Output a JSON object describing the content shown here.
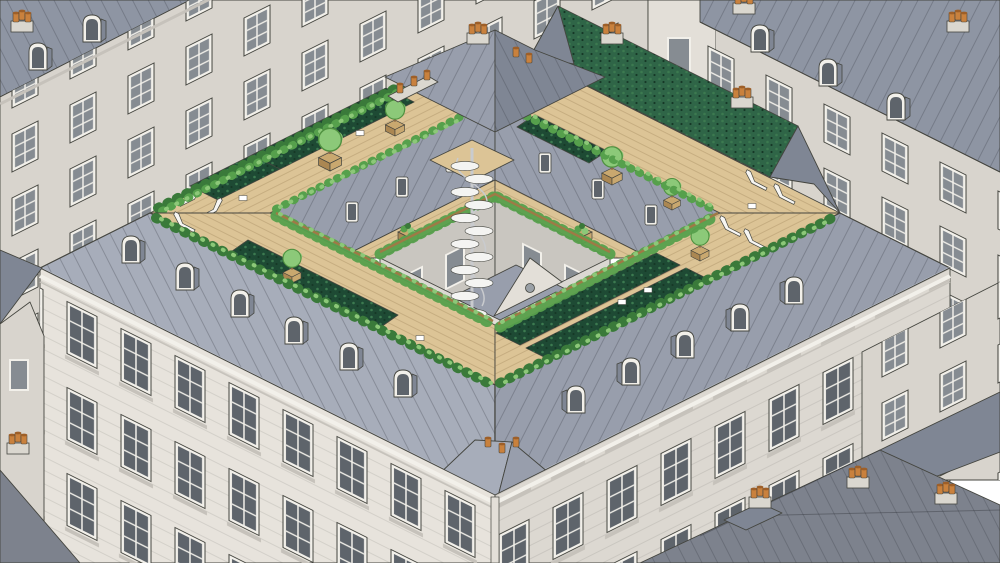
{
  "scene": {
    "description": "Isometric architectural illustration of a Parisian Haussmann-style courtyard block whose rooftops are converted into wooden garden terraces with planters, vegetable beds, sedum green roofs, trees, lounge chairs and a white spiral staircase connecting two terrace levels around the inner courtyard.",
    "objects": [
      "background-apartment-buildings",
      "mansard-roofs",
      "dormer-windows",
      "chimney-stacks-with-terracotta-pots",
      "rooftop-wood-deck-terraces",
      "raised-vegetable-beds",
      "planter-boxes-with-trees",
      "shrub-hedges",
      "climbing-plants-on-railings",
      "white-lounge-chairs",
      "sedum-green-roof-slope",
      "spiral-staircase",
      "inner-courtyard",
      "arched-courtyard-windows",
      "courtyard-pavilion-with-pediment",
      "street-facades-with-tall-windows"
    ]
  },
  "palette": {
    "line": "#44453f",
    "facade_light": "#e3dfd8",
    "facade_mid": "#d8d4cd",
    "facade_shadow": "#c6c2bb",
    "facade_front": "#e7e3dc",
    "facade_front_side": "#dcd8d1",
    "window_glass": "#868c92",
    "window_frame": "#f2f0ea",
    "window_dark": "#5e646b",
    "roof_main": "#989eac",
    "roof_light": "#a7adba",
    "roof_dark": "#7f8694",
    "roof_far": "#8e95a3",
    "roof_neighbor": "#7d828d",
    "courtyard_wall": "#dbd8d2",
    "courtyard_wall_shade": "#c9c6c0",
    "courtyard_floor": "#646a74",
    "arch_glass": "#9aa0a6",
    "deck": "#dcc496",
    "deck_shade": "#cdb281",
    "planter": "#c9a86f",
    "planter_side": "#ab8752",
    "railing": "#9e7a46",
    "bed_dark": "#1e4a34",
    "bed_mid": "#2f6547",
    "shrub": "#56a04c",
    "shrub_light": "#8cc878",
    "shrub_dark": "#3a7a3a",
    "tree": "#8cc979",
    "tree_dark": "#4f9140",
    "trunk": "#8a6a48",
    "pot": "#c9813d",
    "pot_dark": "#9e5f28",
    "stack": "#dad7cf",
    "stair": "#f4f4f2",
    "stair_shade": "#c9cbce",
    "lounger": "#f7f6f3",
    "sky": "#ffffff"
  }
}
